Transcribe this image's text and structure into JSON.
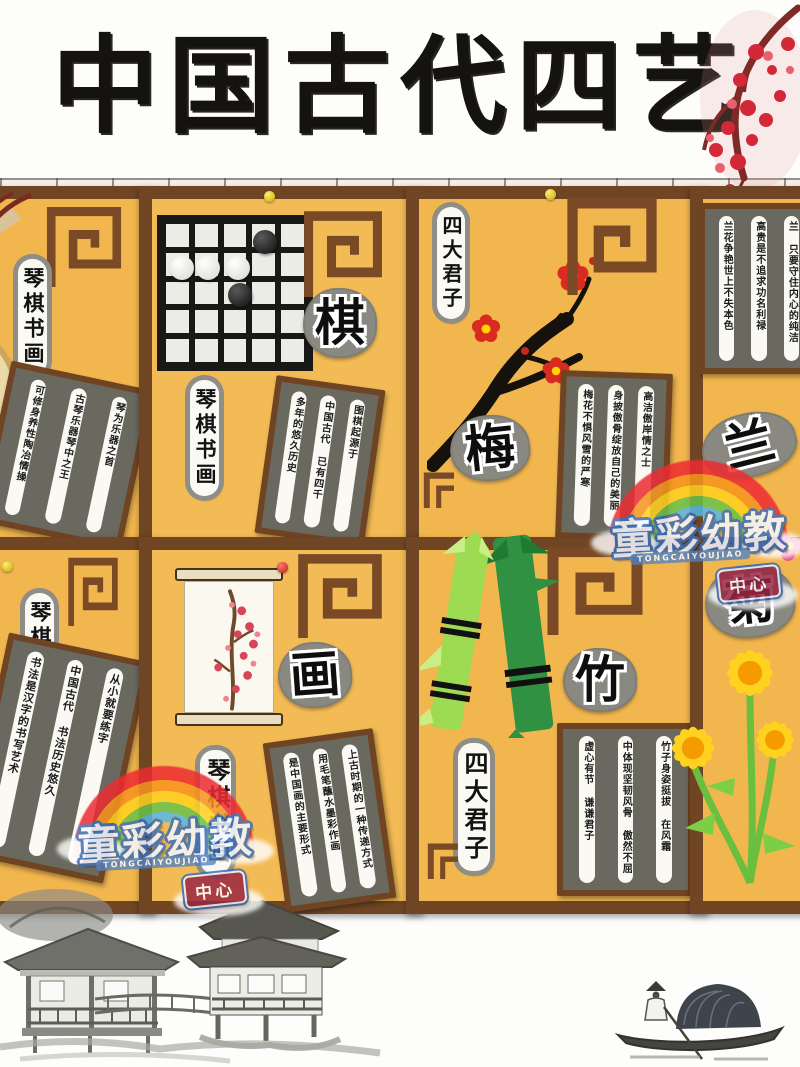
{
  "title": "中国古代四艺",
  "watermark": {
    "name": "童彩幼教",
    "latin": "TONGCAIYOUJIAO",
    "badge": "中心"
  },
  "labels": {
    "four_arts": "琴棋书画",
    "four_gentlemen": "四大君子"
  },
  "panels": {
    "qin": {
      "plaque": [
        "琴为乐器之首",
        "古琴乐器琴中之王",
        "可修身养性陶冶情操"
      ]
    },
    "qi": {
      "big_char": "棋",
      "plaque": [
        "围棋起源于",
        "中国古代 已有四千",
        "多年的悠久历史"
      ]
    },
    "mei": {
      "big_char": "梅",
      "plaque": [
        "高洁傲岸情之士",
        "身披傲骨绽放自己的美丽",
        "梅花不惧风雪的严寒"
      ]
    },
    "lan": {
      "big_char": "兰",
      "plaque": [
        "兰 只要守住内心的纯洁",
        "高贵是不追求功名利禄",
        "兰花争艳世上不失本色"
      ]
    },
    "shu": {
      "plaque": [
        "从小就要练字",
        "中国古代 书法历史悠久",
        "书法是汉字的书写艺术"
      ]
    },
    "hua": {
      "big_char": "画",
      "plaque": [
        "上古时期的一种传递方式",
        "用毛笔蘸水墨彩作画",
        "是中国画的主要形式"
      ]
    },
    "zhu": {
      "big_char": "竹",
      "plaque": [
        "竹子身姿挺拔 在风霜",
        "中体现坚韧风骨 傲然不屈",
        "虚心有节 谦谦君子"
      ]
    },
    "ju": {
      "big_char": "菊"
    }
  }
}
